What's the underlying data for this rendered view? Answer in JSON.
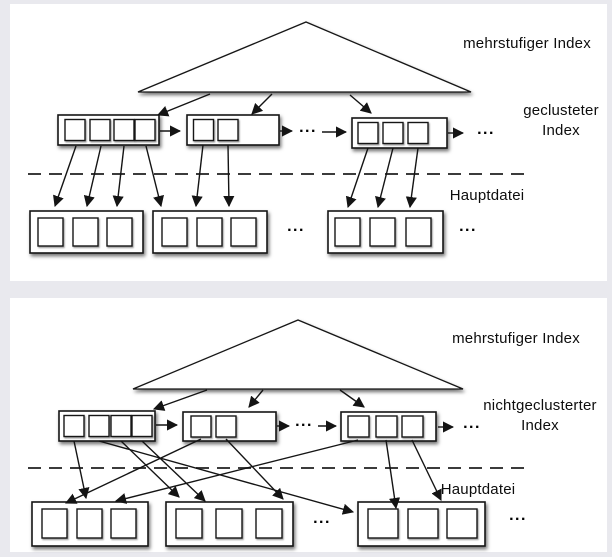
{
  "page": {
    "background": "#e9e9ee",
    "card_background": "#ffffff",
    "line_color": "#141414"
  },
  "panel1": {
    "top_label": "mehrstufiger Index",
    "index_label": "geclusteter\nIndex",
    "file_label": "Hauptdatei",
    "ellipsis": "...",
    "structure": {
      "index_blocks_squares": [
        4,
        2,
        3
      ],
      "data_blocks_squares": [
        3,
        3,
        3
      ]
    }
  },
  "panel2": {
    "top_label": "mehrstufiger Index",
    "index_label": "nichtgeclusterter\nIndex",
    "file_label": "Hauptdatei",
    "ellipsis": "...",
    "structure": {
      "index_blocks_squares": [
        4,
        2,
        3
      ],
      "data_blocks_squares": [
        3,
        3,
        3
      ]
    }
  }
}
